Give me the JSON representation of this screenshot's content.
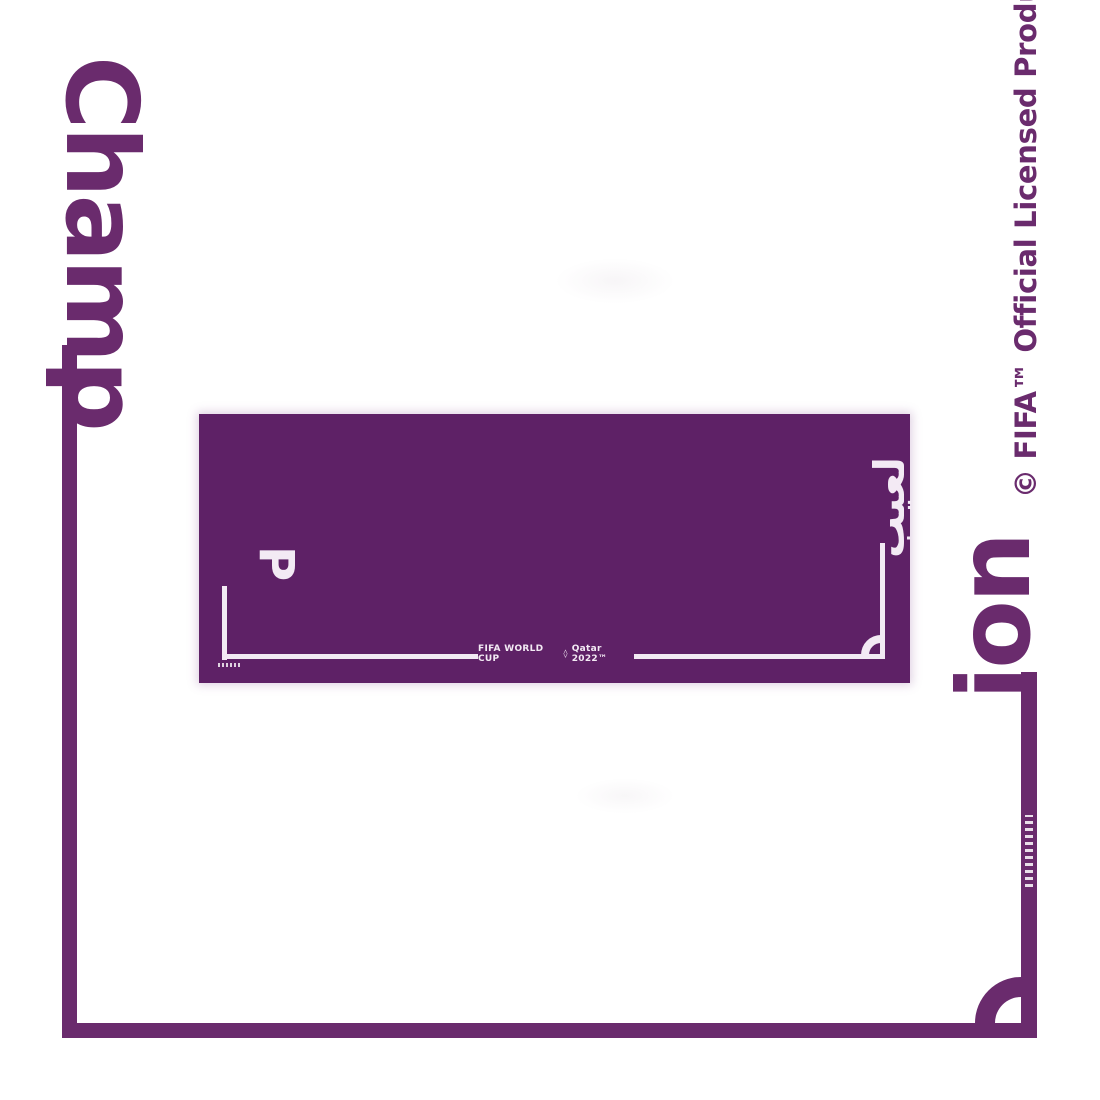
{
  "artwork": {
    "word_left": "Champ",
    "word_right": "ion",
    "license_notice": "© FIFA™ Official Licensed Product.",
    "colors": {
      "background": "#ffffff",
      "purple_ink": "#6a2b6d",
      "towel_purple": "#5e2166",
      "towel_print": "#f3eaf4"
    }
  },
  "towel_print": {
    "latin_letter": "P",
    "arabic_word": "لعيب",
    "wordmark_left": "FIFA WORLD CUP",
    "trophy_mark": "◊",
    "wordmark_right": "Qatar 2022™"
  }
}
